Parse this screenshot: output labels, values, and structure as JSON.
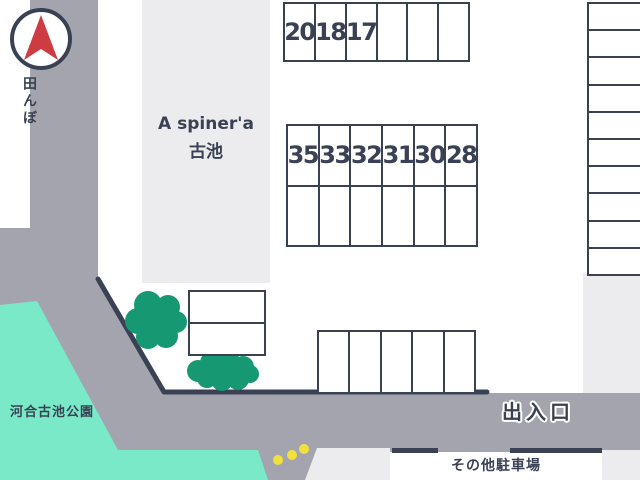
{
  "app": {
    "type": "parking-lot-map"
  },
  "colors": {
    "navy": "#3a4154",
    "road": "#a4a4ae",
    "block": "#ececef",
    "park": "#7ae9c7",
    "tree": "#169872",
    "dot": "#f2e13c",
    "arrow": "#cd3c41"
  },
  "icons": {
    "compass": "north-arrow"
  },
  "labels": {
    "rice_field": "田んぼ",
    "facility_line1": "A spiner'a",
    "facility_line2": "古池",
    "park": "河合古池公園",
    "entrance": "出入口",
    "other_parking": "その他駐車場"
  },
  "grids": {
    "top_row": {
      "rows": 1,
      "cols": 6,
      "labels": [
        "20",
        "18",
        "17",
        "",
        "",
        ""
      ]
    },
    "middle_block": {
      "rows": 2,
      "cols": 6,
      "labels": [
        "35",
        "33",
        "32",
        "31",
        "30",
        "28",
        "",
        "",
        "",
        "",
        "",
        ""
      ]
    },
    "right_column": {
      "rows": 10,
      "cols": 1,
      "labels": [
        "",
        "",
        "",
        "",
        "",
        "",
        "",
        "",
        "",
        ""
      ]
    },
    "small_block": {
      "rows": 2,
      "cols": 1,
      "labels": [
        "",
        ""
      ]
    },
    "bottom_row": {
      "rows": 1,
      "cols": 5,
      "labels": [
        "",
        "",
        "",
        "",
        ""
      ]
    }
  }
}
